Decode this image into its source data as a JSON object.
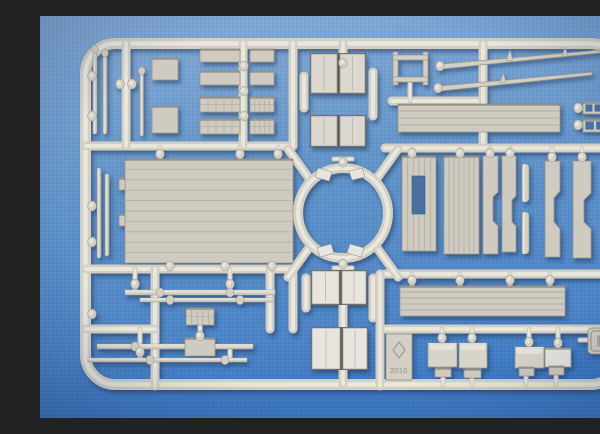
{
  "scene": {
    "type": "photograph",
    "subject": "injection-molded model kit sprue on blue fabric",
    "markings": {
      "letter": "D",
      "year": "2010"
    },
    "colors": {
      "bg_top": "#84abd7",
      "bg_mid": "#6094ca",
      "bg_bottom": "#3b78c3",
      "vignette": "rgba(14,34,78,0.25)",
      "plastic": "#d3cfc4",
      "plastic_light": "#eae7dd",
      "plastic_dark": "#948f85",
      "panel": "#cfcbc0",
      "panel_line": "#b0ac a1",
      "panel_edge": "#9a968b",
      "white_part": "#e7e5de",
      "gap_dark": "#5f5f5a",
      "hole": "#48709e",
      "shadow": "#2e3f5e",
      "emboss_text": "#b9b5aa",
      "emboss_edge": "#85817a"
    }
  },
  "geometry": {
    "frame": {
      "x": 45.5,
      "y": 27.5,
      "w": 535,
      "h": 341,
      "rx": 30,
      "t": 11
    },
    "ring": {
      "cx": 303,
      "cy": 197,
      "r": 45,
      "t": 10
    },
    "spokes": [
      [
        271,
        165,
        248,
        133
      ],
      [
        335,
        165,
        358,
        133
      ],
      [
        271,
        229,
        248,
        261
      ],
      [
        335,
        229,
        358,
        261
      ]
    ],
    "runners": [
      [
        46,
        130,
        253,
        130
      ],
      [
        86,
        27,
        86,
        130
      ],
      [
        203,
        27,
        203,
        130
      ],
      [
        253,
        27,
        253,
        130
      ],
      [
        46,
        253,
        253,
        253
      ],
      [
        303,
        27,
        303,
        40
      ],
      [
        352,
        85,
        443,
        85
      ],
      [
        443,
        27,
        443,
        132
      ],
      [
        345,
        132,
        582,
        132
      ],
      [
        565,
        40,
        565,
        132
      ],
      [
        345,
        258,
        582,
        258
      ],
      [
        345,
        313,
        582,
        313
      ],
      [
        340,
        258,
        340,
        370
      ],
      [
        115,
        253,
        115,
        370
      ],
      [
        230,
        253,
        230,
        313
      ],
      [
        46,
        313,
        115,
        313
      ],
      [
        253,
        258,
        253,
        313
      ],
      [
        303,
        242,
        303,
        256
      ],
      [
        303,
        288,
        303,
        312
      ],
      [
        303,
        352,
        303,
        368
      ],
      [
        264,
        60,
        264,
        92
      ],
      [
        333,
        56,
        333,
        100
      ],
      [
        266,
        262,
        266,
        292
      ],
      [
        333,
        262,
        333,
        302
      ]
    ],
    "stubs": [
      [
        294,
        143,
        312,
        143
      ],
      [
        294,
        252,
        312,
        252
      ],
      [
        538,
        92,
        545,
        92
      ],
      [
        566,
        92,
        573,
        92
      ],
      [
        538,
        109,
        545,
        109
      ],
      [
        566,
        109,
        573,
        109
      ],
      [
        540,
        324,
        548,
        324
      ],
      [
        403,
        361,
        403,
        369
      ],
      [
        432,
        362,
        432,
        369
      ],
      [
        486,
        360,
        486,
        369
      ],
      [
        516,
        359,
        516,
        369
      ],
      [
        95,
        253,
        95,
        276
      ],
      [
        190,
        253,
        190,
        276
      ],
      [
        160,
        310,
        160,
        330
      ],
      [
        100,
        313,
        100,
        344
      ],
      [
        190,
        332,
        190,
        344
      ],
      [
        120,
        131,
        120,
        144
      ],
      [
        200,
        131,
        200,
        144
      ],
      [
        238,
        131,
        238,
        144
      ],
      [
        130,
        247,
        130,
        254
      ],
      [
        185,
        247,
        185,
        254
      ],
      [
        232,
        247,
        232,
        254
      ],
      [
        372,
        132,
        372,
        142
      ],
      [
        420,
        132,
        420,
        142
      ],
      [
        450,
        132,
        450,
        142
      ],
      [
        470,
        132,
        470,
        142
      ],
      [
        512,
        132,
        512,
        147
      ],
      [
        542,
        132,
        542,
        147
      ],
      [
        372,
        258,
        372,
        272
      ],
      [
        420,
        258,
        420,
        272
      ],
      [
        470,
        258,
        470,
        272
      ],
      [
        510,
        258,
        510,
        272
      ],
      [
        402,
        313,
        402,
        328
      ],
      [
        432,
        313,
        432,
        328
      ],
      [
        489,
        313,
        489,
        332
      ],
      [
        518,
        313,
        518,
        333
      ],
      [
        370,
        68,
        370,
        85
      ]
    ],
    "knobs": [
      [
        120,
        138
      ],
      [
        200,
        138
      ],
      [
        238,
        138
      ],
      [
        130,
        250
      ],
      [
        185,
        250
      ],
      [
        232,
        250
      ],
      [
        80,
        68
      ],
      [
        92,
        68
      ],
      [
        204,
        50
      ],
      [
        204,
        75
      ],
      [
        204,
        100
      ],
      [
        303,
        47
      ],
      [
        400,
        50
      ],
      [
        398,
        72
      ],
      [
        372,
        137
      ],
      [
        420,
        137
      ],
      [
        450,
        137
      ],
      [
        470,
        137
      ],
      [
        512,
        141
      ],
      [
        542,
        141
      ],
      [
        538,
        92
      ],
      [
        571,
        92
      ],
      [
        538,
        109
      ],
      [
        571,
        109
      ],
      [
        372,
        264
      ],
      [
        420,
        264
      ],
      [
        470,
        264
      ],
      [
        510,
        264
      ],
      [
        402,
        322
      ],
      [
        432,
        322
      ],
      [
        489,
        326
      ],
      [
        518,
        327
      ],
      [
        52,
        60
      ],
      [
        52,
        100
      ],
      [
        52,
        190
      ],
      [
        52,
        226
      ],
      [
        52,
        298
      ],
      [
        575,
        64
      ],
      [
        575,
        120
      ],
      [
        566,
        135
      ],
      [
        95,
        268
      ],
      [
        190,
        268
      ],
      [
        160,
        320
      ],
      [
        100,
        336
      ],
      [
        303,
        146
      ],
      [
        303,
        248
      ]
    ],
    "panels": [
      {
        "x": 160,
        "y": 33,
        "w": 40,
        "h": 13,
        "k": "pl"
      },
      {
        "x": 210,
        "y": 33,
        "w": 24,
        "h": 13,
        "k": "pl"
      },
      {
        "x": 160,
        "y": 55,
        "w": 40,
        "h": 14,
        "k": "pl"
      },
      {
        "x": 210,
        "y": 55,
        "w": 24,
        "h": 14,
        "k": "pl"
      },
      {
        "x": 160,
        "y": 81,
        "w": 40,
        "h": 15,
        "k": "la"
      },
      {
        "x": 210,
        "y": 81,
        "w": 24,
        "h": 15,
        "k": "la"
      },
      {
        "x": 160,
        "y": 103,
        "w": 40,
        "h": 15,
        "k": "la"
      },
      {
        "x": 210,
        "y": 103,
        "w": 24,
        "h": 15,
        "k": "la"
      },
      {
        "x": 112,
        "y": 42,
        "w": 26,
        "h": 22,
        "k": "pl"
      },
      {
        "x": 112,
        "y": 90,
        "w": 26,
        "h": 27,
        "k": "pl"
      },
      {
        "x": 85,
        "y": 143,
        "w": 168,
        "h": 104,
        "k": "ph",
        "n": 10
      },
      {
        "x": 79,
        "y": 162,
        "w": 6,
        "h": 12,
        "k": "pl"
      },
      {
        "x": 79,
        "y": 198,
        "w": 6,
        "h": 12,
        "k": "pl"
      },
      {
        "x": 358,
        "y": 88,
        "w": 162,
        "h": 28,
        "k": "ph",
        "n": 4
      },
      {
        "x": 362,
        "y": 140,
        "w": 34,
        "h": 95,
        "k": "pv",
        "n": 6,
        "hole": [
          372,
          160,
          13,
          38
        ]
      },
      {
        "x": 404,
        "y": 140,
        "w": 35,
        "h": 98,
        "k": "pv",
        "n": 7
      },
      {
        "x": 360,
        "y": 270,
        "w": 165,
        "h": 30,
        "k": "ph",
        "n": 5
      },
      {
        "x": 146,
        "y": 292,
        "w": 28,
        "h": 17,
        "k": "la"
      },
      {
        "x": 145,
        "y": 322,
        "w": 30,
        "h": 18,
        "k": "pl"
      },
      {
        "x": 543,
        "y": 86,
        "w": 21,
        "h": 12,
        "k": "wi"
      },
      {
        "x": 543,
        "y": 103,
        "w": 24,
        "h": 13,
        "k": "wi"
      },
      {
        "x": 388,
        "y": 327,
        "w": 29,
        "h": 24,
        "k": "bx"
      },
      {
        "x": 419,
        "y": 327,
        "w": 28,
        "h": 25,
        "k": "bx"
      },
      {
        "x": 475,
        "y": 331,
        "w": 29,
        "h": 21,
        "k": "bx"
      },
      {
        "x": 505,
        "y": 332,
        "w": 26,
        "h": 19,
        "k": "wh"
      },
      {
        "x": 395,
        "y": 352,
        "w": 16,
        "h": 9,
        "k": "pl"
      },
      {
        "x": 424,
        "y": 353,
        "w": 17,
        "h": 9,
        "k": "pl"
      },
      {
        "x": 479,
        "y": 351,
        "w": 15,
        "h": 9,
        "k": "pl"
      },
      {
        "x": 509,
        "y": 350,
        "w": 15,
        "h": 9,
        "k": "pl"
      }
    ],
    "doorpairs": [
      {
        "x": 271,
        "y": 38,
        "w1": 26,
        "w2": 25,
        "gap": 3,
        "h": 39,
        "tone": "base"
      },
      {
        "x": 271,
        "y": 100,
        "w1": 26,
        "w2": 25,
        "gap": 3,
        "h": 30,
        "tone": "base"
      },
      {
        "x": 272,
        "y": 255,
        "w1": 27,
        "w2": 24,
        "gap": 3,
        "h": 33,
        "tone": "white"
      },
      {
        "x": 272,
        "y": 312,
        "w1": 28,
        "w2": 24,
        "gap": 3,
        "h": 41,
        "tone": "white"
      }
    ],
    "rails": [
      {
        "x": 85,
        "y": 274,
        "w": 150,
        "h": 5,
        "b": [
          120,
          190
        ]
      },
      {
        "x": 100,
        "y": 282,
        "w": 133,
        "h": 4,
        "b": [
          130,
          200
        ]
      },
      {
        "x": 57,
        "y": 328,
        "w": 156,
        "h": 5,
        "b": [
          95,
          160
        ]
      },
      {
        "x": 48,
        "y": 342,
        "w": 159,
        "h": 4,
        "b": [
          110,
          185
        ]
      }
    ],
    "rods": [
      {
        "x": 53,
        "y": 36,
        "w": 4,
        "h": 82,
        "kn": true
      },
      {
        "x": 63,
        "y": 40,
        "w": 4,
        "h": 78,
        "kn": true
      },
      {
        "x": 100,
        "y": 58,
        "w": 3.5,
        "h": 62,
        "kn": true
      },
      {
        "x": 57,
        "y": 152,
        "w": 4,
        "h": 90,
        "kn": false
      },
      {
        "x": 65,
        "y": 158,
        "w": 4,
        "h": 82,
        "kn": false
      },
      {
        "x": 482,
        "y": 148,
        "w": 7,
        "h": 38,
        "kn": false
      },
      {
        "x": 482,
        "y": 196,
        "w": 7,
        "h": 42,
        "kn": false
      },
      {
        "x": 567,
        "y": 140,
        "w": 8,
        "h": 28,
        "kn": false
      },
      {
        "x": 567,
        "y": 178,
        "w": 8,
        "h": 26,
        "kn": false
      }
    ],
    "barrels": [
      {
        "pts": "402,53 470,46 560,37 560,34 470,42 402,48",
        "fins": [
          "466,45 470,34 473,44",
          "522,41 525,31 528,40"
        ]
      },
      {
        "pts": "400,75 478,67 552,59 552,56 478,63 400,70",
        "fins": [
          "460,67 463,57 466,66"
        ]
      }
    ],
    "ladder": {
      "posts": [
        [
          353,
          36,
          5,
          33
        ],
        [
          383,
          36,
          5,
          33
        ]
      ],
      "rungs": [
        [
          353,
          39,
          35,
          5
        ],
        [
          353,
          61,
          35,
          5
        ]
      ]
    },
    "chassis": [
      "M443,140h15v36l-5,5v24l5,5v28h-15z",
      "M462,140h14v40l-4,4v22l4,4v26h-14z",
      "M505,145h15v30l-6,7v24l6,7v28h-15z",
      "M533,145h18v32l-7,7v22l7,7v29h-18z"
    ],
    "clips": [
      "278,152 292,156 289,165 275,161",
      "309,155 322,152 325,161 312,164",
      "277,232 291,228 294,237 280,241",
      "310,228 324,232 321,241 307,237"
    ],
    "d_plate": {
      "x": 548,
      "y": 312,
      "w": 28,
      "h": 26,
      "rx": 4
    },
    "year_tab": {
      "x": 346,
      "y": 318,
      "w": 26,
      "h": 46,
      "logo": "359,326 365,334 359,342 353,334"
    }
  }
}
